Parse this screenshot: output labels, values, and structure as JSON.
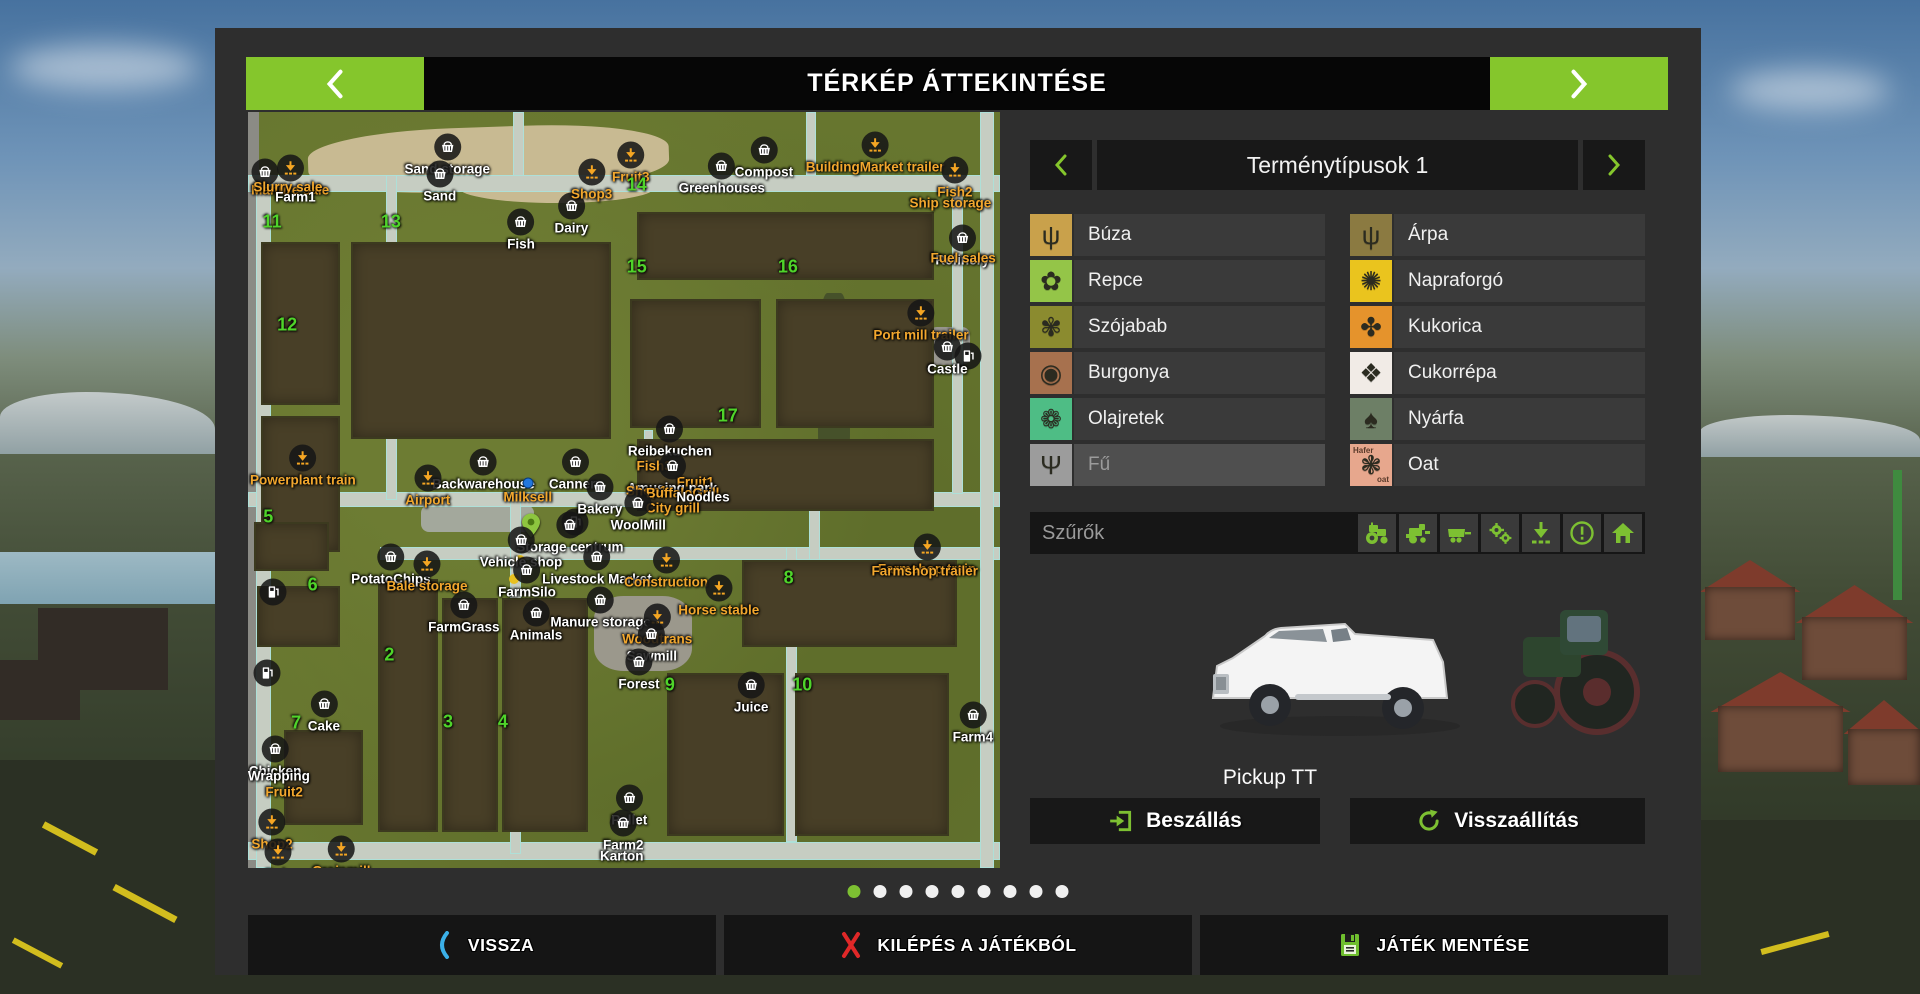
{
  "title_bar": {
    "title": "TÉRKÉP ÁTTEKINTÉSE"
  },
  "crops_panel": {
    "title": "Terménytípusok 1",
    "columns": [
      {
        "items": [
          {
            "label": "Búza",
            "icon": "wheat-icon",
            "color": "#c9a14b",
            "glyph": "ψ"
          },
          {
            "label": "Repce",
            "icon": "rapeseed-icon",
            "color": "#94c548",
            "glyph": "✿"
          },
          {
            "label": "Szójabab",
            "icon": "soybean-icon",
            "color": "#8b8b2f",
            "glyph": "✾"
          },
          {
            "label": "Burgonya",
            "icon": "potato-icon",
            "color": "#a7714e",
            "glyph": "◉"
          },
          {
            "label": "Olajretek",
            "icon": "oilseed-radish-icon",
            "color": "#4ebd85",
            "glyph": "❁"
          },
          {
            "label": "Fű",
            "icon": "grass-icon",
            "color": "#9c9c9c",
            "glyph": "Ψ",
            "disabled": true
          }
        ]
      },
      {
        "items": [
          {
            "label": "Árpa",
            "icon": "barley-icon",
            "color": "#8b7a41",
            "glyph": "ψ"
          },
          {
            "label": "Napraforgó",
            "icon": "sunflower-icon",
            "color": "#eac41e",
            "glyph": "✺"
          },
          {
            "label": "Kukorica",
            "icon": "corn-icon",
            "color": "#e5932c",
            "glyph": "✤"
          },
          {
            "label": "Cukorrépa",
            "icon": "sugar-beet-icon",
            "color": "#f1ebe6",
            "glyph": "❖"
          },
          {
            "label": "Nyárfa",
            "icon": "poplar-icon",
            "color": "#6d7f66",
            "glyph": "♠"
          },
          {
            "label": "Oat",
            "icon": "oat-icon",
            "color": "#e7a78d",
            "glyph": "❃",
            "icon_text": [
              "Hafer",
              "oat"
            ]
          }
        ]
      }
    ]
  },
  "filters": {
    "label": "Szűrők",
    "icons": [
      {
        "name": "tractor-filter-icon"
      },
      {
        "name": "harvester-filter-icon"
      },
      {
        "name": "trailer-filter-icon"
      },
      {
        "name": "gears-filter-icon"
      },
      {
        "name": "unloading-filter-icon"
      },
      {
        "name": "warning-filter-icon"
      },
      {
        "name": "home-filter-icon"
      }
    ]
  },
  "vehicle": {
    "name": "Pickup TT"
  },
  "actions": {
    "enter_label": "Beszállás",
    "reset_label": "Visszaállítás"
  },
  "pagination": {
    "total": 9,
    "active_index": 0
  },
  "bottom_bar": {
    "back_label": "VISSZA",
    "quit_label": "KILÉPÉS A JÁTÉKBÓL",
    "save_label": "JÁTÉK MENTÉSE"
  },
  "map": {
    "accent_orange": "#f2a72e",
    "accent_green_number": "#4fd42a",
    "field_numbers": [
      {
        "n": "11",
        "x": 3.2,
        "y": 14.6
      },
      {
        "n": "13",
        "x": 19.0,
        "y": 14.6
      },
      {
        "n": "14",
        "x": 51.7,
        "y": 9.7
      },
      {
        "n": "15",
        "x": 51.7,
        "y": 20.5
      },
      {
        "n": "16",
        "x": 71.8,
        "y": 20.5
      },
      {
        "n": "12",
        "x": 5.2,
        "y": 28.2
      },
      {
        "n": "17",
        "x": 63.8,
        "y": 40.2
      },
      {
        "n": "5",
        "x": 2.7,
        "y": 53.6
      },
      {
        "n": "6",
        "x": 8.6,
        "y": 62.6
      },
      {
        "n": "2",
        "x": 18.8,
        "y": 71.8
      },
      {
        "n": "8",
        "x": 71.9,
        "y": 61.6
      },
      {
        "n": "7",
        "x": 6.4,
        "y": 80.8
      },
      {
        "n": "3",
        "x": 26.6,
        "y": 80.7
      },
      {
        "n": "4",
        "x": 33.9,
        "y": 80.7
      },
      {
        "n": "9",
        "x": 56.1,
        "y": 75.8
      },
      {
        "n": "10",
        "x": 73.7,
        "y": 75.8
      }
    ],
    "labels": [
      {
        "text": "Manure sale",
        "color": "orange",
        "x": 5.6,
        "y": 8.5,
        "marker": "download"
      },
      {
        "text": "Slurry sale",
        "color": "orange",
        "x": 5.3,
        "y": 9.9,
        "marker": "none"
      },
      {
        "text": "Farm1",
        "color": "white",
        "x": 6.3,
        "y": 11.3,
        "marker": "none"
      },
      {
        "text": "Sand storage",
        "color": "white",
        "x": 26.5,
        "y": 5.7,
        "marker": "basket"
      },
      {
        "text": "Sand",
        "color": "white",
        "x": 25.5,
        "y": 9.3,
        "marker": "basket"
      },
      {
        "text": "Fish",
        "color": "white",
        "x": 36.3,
        "y": 15.6,
        "marker": "basket"
      },
      {
        "text": "Dairy",
        "color": "white",
        "x": 43.0,
        "y": 13.5,
        "marker": "basket"
      },
      {
        "text": "Shop3",
        "color": "orange",
        "x": 45.7,
        "y": 9.0,
        "marker": "download"
      },
      {
        "text": "Fruit3",
        "color": "orange",
        "x": 50.9,
        "y": 6.7,
        "marker": "download"
      },
      {
        "text": "Greenhouses",
        "color": "white",
        "x": 63.0,
        "y": 8.2,
        "marker": "basket"
      },
      {
        "text": "Compost",
        "color": "white",
        "x": 68.6,
        "y": 6.1,
        "marker": "basket"
      },
      {
        "text": "BuildingMarket trailer",
        "color": "orange",
        "x": 83.4,
        "y": 5.4,
        "marker": "download"
      },
      {
        "text": "Fish2",
        "color": "orange",
        "x": 94.0,
        "y": 8.7,
        "marker": "download"
      },
      {
        "text": "Ship storage",
        "color": "orange",
        "x": 93.4,
        "y": 12.0,
        "marker": "none"
      },
      {
        "text": "Refinery",
        "color": "white",
        "x": 95.0,
        "y": 17.7,
        "marker": "basket"
      },
      {
        "text": "Fuel sales",
        "color": "orange",
        "x": 95.1,
        "y": 19.3,
        "marker": "none"
      },
      {
        "text": "Port mill trailer",
        "color": "orange",
        "x": 89.5,
        "y": 27.6,
        "marker": "download"
      },
      {
        "text": "Castle",
        "color": "white",
        "x": 93.0,
        "y": 32.1,
        "marker": "basket"
      },
      {
        "text": "Powerplant train",
        "color": "orange",
        "x": 7.3,
        "y": 46.8,
        "marker": "download"
      },
      {
        "text": "Reibekuchen",
        "color": "white",
        "x": 56.1,
        "y": 43.0,
        "marker": "basket"
      },
      {
        "text": "Backwarehouse",
        "color": "white",
        "x": 31.3,
        "y": 47.4,
        "marker": "basket"
      },
      {
        "text": "Cannery",
        "color": "white",
        "x": 43.6,
        "y": 47.4,
        "marker": "basket"
      },
      {
        "text": "Airport",
        "color": "orange",
        "x": 23.9,
        "y": 49.5,
        "marker": "download"
      },
      {
        "text": "Milksell",
        "color": "orange",
        "x": 37.2,
        "y": 50.1,
        "marker": "dot-blue"
      },
      {
        "text": "Fish3",
        "color": "orange",
        "x": 54.0,
        "y": 46.8,
        "marker": "none"
      },
      {
        "text": "Fruit1",
        "color": "orange",
        "x": 59.5,
        "y": 48.9,
        "marker": "none"
      },
      {
        "text": "Amusing park",
        "color": "white",
        "x": 56.4,
        "y": 47.9,
        "marker": "basket"
      },
      {
        "text": "Shop1",
        "color": "orange",
        "x": 53.0,
        "y": 50.1,
        "marker": "none"
      },
      {
        "text": "BuffaloGrill",
        "color": "orange",
        "x": 57.8,
        "y": 50.4,
        "marker": "none"
      },
      {
        "text": "Noodles",
        "color": "white",
        "x": 60.5,
        "y": 50.9,
        "marker": "none"
      },
      {
        "text": "City grill",
        "color": "orange",
        "x": 56.5,
        "y": 52.4,
        "marker": "none"
      },
      {
        "text": "Bakery",
        "color": "white",
        "x": 46.8,
        "y": 50.7,
        "marker": "basket"
      },
      {
        "text": "WoolMill",
        "color": "white",
        "x": 51.9,
        "y": 52.8,
        "marker": "basket"
      },
      {
        "text": "Storage centrum",
        "color": "white",
        "x": 42.8,
        "y": 55.7,
        "marker": "basket"
      },
      {
        "text": "Vehicle shop",
        "color": "white",
        "x": 36.3,
        "y": 57.7,
        "marker": "basket"
      },
      {
        "text": "PotatoChips",
        "color": "white",
        "x": 19.0,
        "y": 59.9,
        "marker": "basket"
      },
      {
        "text": "Bale storage",
        "color": "orange",
        "x": 23.8,
        "y": 60.9,
        "marker": "download"
      },
      {
        "text": "FarmSilo",
        "color": "white",
        "x": 37.1,
        "y": 61.6,
        "marker": "basket"
      },
      {
        "text": "Livestock Market",
        "color": "white",
        "x": 46.4,
        "y": 59.9,
        "marker": "basket"
      },
      {
        "text": "Construction",
        "color": "orange",
        "x": 55.6,
        "y": 60.3,
        "marker": "download"
      },
      {
        "text": "Horse stable",
        "color": "orange",
        "x": 62.6,
        "y": 64.0,
        "marker": "download"
      },
      {
        "text": "Farmshop train",
        "color": "orange",
        "x": 90.3,
        "y": 58.6,
        "marker": "download"
      },
      {
        "text": "Farmshop trailer",
        "color": "orange",
        "x": 90.0,
        "y": 60.7,
        "marker": "none"
      },
      {
        "text": "FarmGrass",
        "color": "white",
        "x": 28.7,
        "y": 66.3,
        "marker": "basket"
      },
      {
        "text": "Animals",
        "color": "white",
        "x": 38.3,
        "y": 67.3,
        "marker": "basket"
      },
      {
        "text": "Manure storage",
        "color": "white",
        "x": 46.9,
        "y": 65.6,
        "marker": "basket"
      },
      {
        "text": "Woodtrans",
        "color": "orange",
        "x": 54.4,
        "y": 67.9,
        "marker": "download"
      },
      {
        "text": "Sawmill",
        "color": "white",
        "x": 53.7,
        "y": 70.1,
        "marker": "basket"
      },
      {
        "text": "Forest",
        "color": "white",
        "x": 52.0,
        "y": 73.8,
        "marker": "basket"
      },
      {
        "text": "Cake",
        "color": "white",
        "x": 10.1,
        "y": 79.4,
        "marker": "basket"
      },
      {
        "text": "Chicken",
        "color": "white",
        "x": 3.6,
        "y": 85.3,
        "marker": "basket"
      },
      {
        "text": "Wrapping",
        "color": "white",
        "x": 4.1,
        "y": 87.8,
        "marker": "none"
      },
      {
        "text": "Fruit2",
        "color": "orange",
        "x": 4.8,
        "y": 90.0,
        "marker": "none"
      },
      {
        "text": "Shop2",
        "color": "orange",
        "x": 3.2,
        "y": 95.0,
        "marker": "download"
      },
      {
        "text": "Pub",
        "color": "orange",
        "x": 4.0,
        "y": 99.0,
        "marker": "download"
      },
      {
        "text": "Grainmill",
        "color": "orange",
        "x": 12.4,
        "y": 98.6,
        "marker": "download"
      },
      {
        "text": "Juice",
        "color": "white",
        "x": 66.9,
        "y": 76.9,
        "marker": "basket"
      },
      {
        "text": "Farm4",
        "color": "white",
        "x": 96.4,
        "y": 80.8,
        "marker": "basket"
      },
      {
        "text": "Pallet",
        "color": "white",
        "x": 50.7,
        "y": 91.8,
        "marker": "basket"
      },
      {
        "text": "Farm2",
        "color": "white",
        "x": 49.9,
        "y": 95.1,
        "marker": "basket"
      },
      {
        "text": "Karton",
        "color": "white",
        "x": 49.7,
        "y": 98.4,
        "marker": "none"
      }
    ],
    "extra_markers": [
      {
        "type": "basket",
        "x": 2.3,
        "y": 8.0
      },
      {
        "type": "fuel",
        "x": 3.3,
        "y": 63.5
      },
      {
        "type": "fuel",
        "x": 2.5,
        "y": 74.2
      },
      {
        "type": "fuel",
        "x": 95.8,
        "y": 32.3
      },
      {
        "type": "fuel",
        "x": 43.5,
        "y": 54.2
      },
      {
        "type": "pin-green",
        "x": 37.6,
        "y": 55.0
      },
      {
        "type": "dot-yellow",
        "x": 36.2,
        "y": 59.3
      },
      {
        "type": "dot-yellow",
        "x": 35.4,
        "y": 61.8
      }
    ],
    "fields": [
      {
        "x": 2,
        "y": 17.5,
        "w": 10,
        "h": 21
      },
      {
        "x": 14,
        "y": 17.5,
        "w": 34,
        "h": 25.5
      },
      {
        "x": 2,
        "y": 40.5,
        "w": 10,
        "h": 17.5
      },
      {
        "x": 52,
        "y": 13.5,
        "w": 39,
        "h": 8.5
      },
      {
        "x": 51,
        "y": 25,
        "w": 17,
        "h": 16.5
      },
      {
        "x": 70.5,
        "y": 25,
        "w": 20.5,
        "h": 16.5
      },
      {
        "x": 52,
        "y": 43.5,
        "w": 39,
        "h": 9
      },
      {
        "x": 1,
        "y": 54.5,
        "w": 9.5,
        "h": 6
      },
      {
        "x": 1.5,
        "y": 63,
        "w": 10.5,
        "h": 7.5
      },
      {
        "x": 17.5,
        "y": 62,
        "w": 7.5,
        "h": 33
      },
      {
        "x": 26,
        "y": 64.5,
        "w": 7,
        "h": 30.5
      },
      {
        "x": 34,
        "y": 64.5,
        "w": 11,
        "h": 30.5
      },
      {
        "x": 56,
        "y": 74.5,
        "w": 15,
        "h": 21
      },
      {
        "x": 73,
        "y": 74.5,
        "w": 20,
        "h": 21
      },
      {
        "x": 66,
        "y": 59.5,
        "w": 28,
        "h": 11
      },
      {
        "x": 5,
        "y": 82,
        "w": 10,
        "h": 12
      }
    ],
    "roads": [
      {
        "x": 0,
        "y": 8.3,
        "w": 100,
        "h": 2.3
      },
      {
        "x": 0,
        "y": 50.2,
        "w": 100,
        "h": 2.0
      },
      {
        "x": 17.5,
        "y": 57.6,
        "w": 82.5,
        "h": 1.7
      },
      {
        "x": 0,
        "y": 96.6,
        "w": 100,
        "h": 2.4
      },
      {
        "x": 1.1,
        "y": 8.3,
        "w": 1.9,
        "h": 91.7
      },
      {
        "x": 97.3,
        "y": 0,
        "w": 1.9,
        "h": 100
      },
      {
        "x": 18.3,
        "y": 8.3,
        "w": 1.5,
        "h": 43
      },
      {
        "x": 34.8,
        "y": 50.2,
        "w": 1.5,
        "h": 48
      },
      {
        "x": 93.6,
        "y": 10,
        "w": 1.5,
        "h": 40.5
      },
      {
        "x": 74.6,
        "y": 50.2,
        "w": 1.4,
        "h": 9
      },
      {
        "x": 71.6,
        "y": 57.6,
        "w": 1.4,
        "h": 39
      },
      {
        "x": 35.2,
        "y": 0,
        "w": 1.5,
        "h": 8.5
      },
      {
        "x": 74.2,
        "y": 0,
        "w": 1.4,
        "h": 8.5
      },
      {
        "x": 52.6,
        "y": 42,
        "w": 1.3,
        "h": 9
      }
    ]
  }
}
